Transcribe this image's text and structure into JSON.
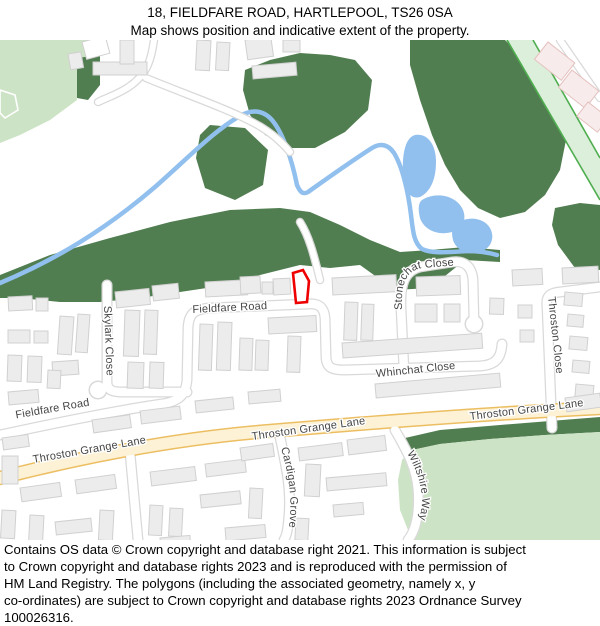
{
  "title": {
    "line1": "18, FIELDFARE ROAD, HARTLEPOOL, TS26 0SA",
    "line2": "Map shows position and indicative extent of the property."
  },
  "footer": {
    "lines": [
      "Contains OS data © Crown copyright and database right 2021. This information is subject",
      "to Crown copyright and database rights 2023 and is reproduced with the permission of",
      "HM Land Registry. The polygons (including the associated geometry, namely x, y",
      "co-ordinates) are subject to Crown copyright and database rights 2023 Ordnance Survey",
      "100026316."
    ]
  },
  "map": {
    "streets": {
      "fieldfare_upper": "Fieldfare Road",
      "fieldfare_lower": "Fieldfare Road",
      "skylark": "Skylark Close",
      "stonechat": "Stonechat Close",
      "whinchat": "Whinchat Close",
      "throston_close": "Throston Close",
      "tgl_left": "Throston Grange Lane",
      "tgl_mid": "Throston Grange Lane",
      "tgl_right": "Throston Grange Lane",
      "cardigan": "Cardigan Grove",
      "wiltshire": "Wiltshire Way"
    }
  },
  "colors": {
    "wood": "#517e50",
    "field": "#cde3c5",
    "path_fill": "#dcefdb",
    "path_edge": "#4fae4f",
    "water": "#92c0ee",
    "casing": "#d9d9d9",
    "road": "#ffffff",
    "yellow_fill": "#fdf2d5",
    "yellow_casing": "#ecbe62",
    "bld": "#ececec",
    "bld_stroke": "#d1d0d0",
    "pink": "#f7eceb",
    "pink_stroke": "#e5c1bf",
    "label": "#454545",
    "red": "#ee0000"
  }
}
